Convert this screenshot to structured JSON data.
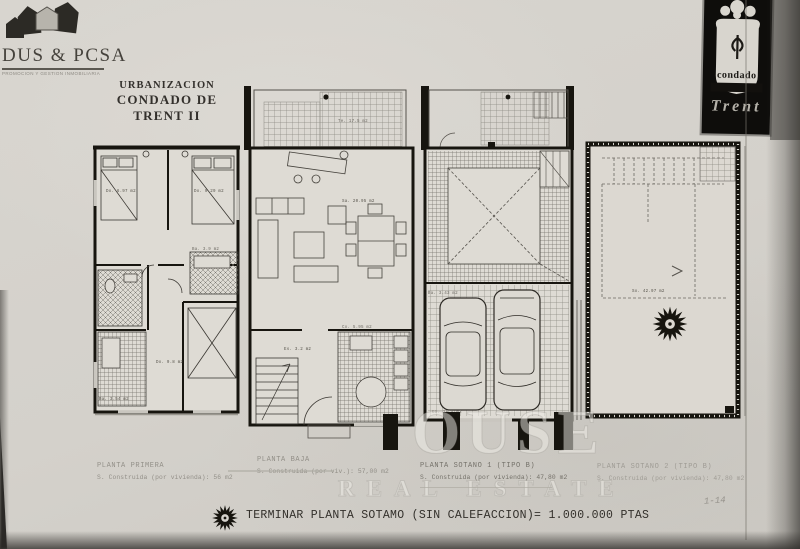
{
  "agency": {
    "name": "DUS & PCSA",
    "tagline": "PROMOCION Y GESTION INMOBILIARIA"
  },
  "title": {
    "line1": "URBANIZACION",
    "line2": "CONDADO DE TRENT II"
  },
  "crest": {
    "word": "condado",
    "name": "Trent"
  },
  "plans": [
    {
      "caption": "PLANTA PRIMERA",
      "area": "S. Construida (por vivienda): 56 m2",
      "rooms": {
        "bed1": "Do. 6.97 m2",
        "bed2": "Do. 9.29 m2",
        "bath1": "Ba. 3.9 m2",
        "bath2": "Ba. 3.54 m2",
        "bed3": "Do. 9.8 m2"
      }
    },
    {
      "caption": "PLANTA BAJA",
      "area": "S. Construida (por viv.): 57,00 m2",
      "rooms": {
        "terrace": "Te. 17.5 m2",
        "salon": "Sa. 20.95 m2",
        "stairs": "Es. 3.2 m2",
        "kitchen": "Co. 5.95 m2"
      }
    },
    {
      "caption": "PLANTA SOTANO 1 (TIPO B)",
      "area": "S. Construida (por vivienda): 47,80 m2",
      "rooms": {
        "bath": "Ba. 3.43 m2",
        "garage": "Ga. 26.4 m2"
      }
    },
    {
      "caption": "PLANTA SOTANO 2 (TIPO B)",
      "area": "S. Construida (por vivienda): 47,80 m2",
      "rooms": {
        "basement": "So. 42.97 m2"
      }
    }
  ],
  "footer": {
    "note": "TERMINAR PLANTA SOTAMO (SIN CALEFACCION)= 1.000.000 PTAS",
    "page_mark": "1-14"
  },
  "watermark": {
    "line1": "OUSE",
    "line2": "REAL ESTATE"
  }
}
